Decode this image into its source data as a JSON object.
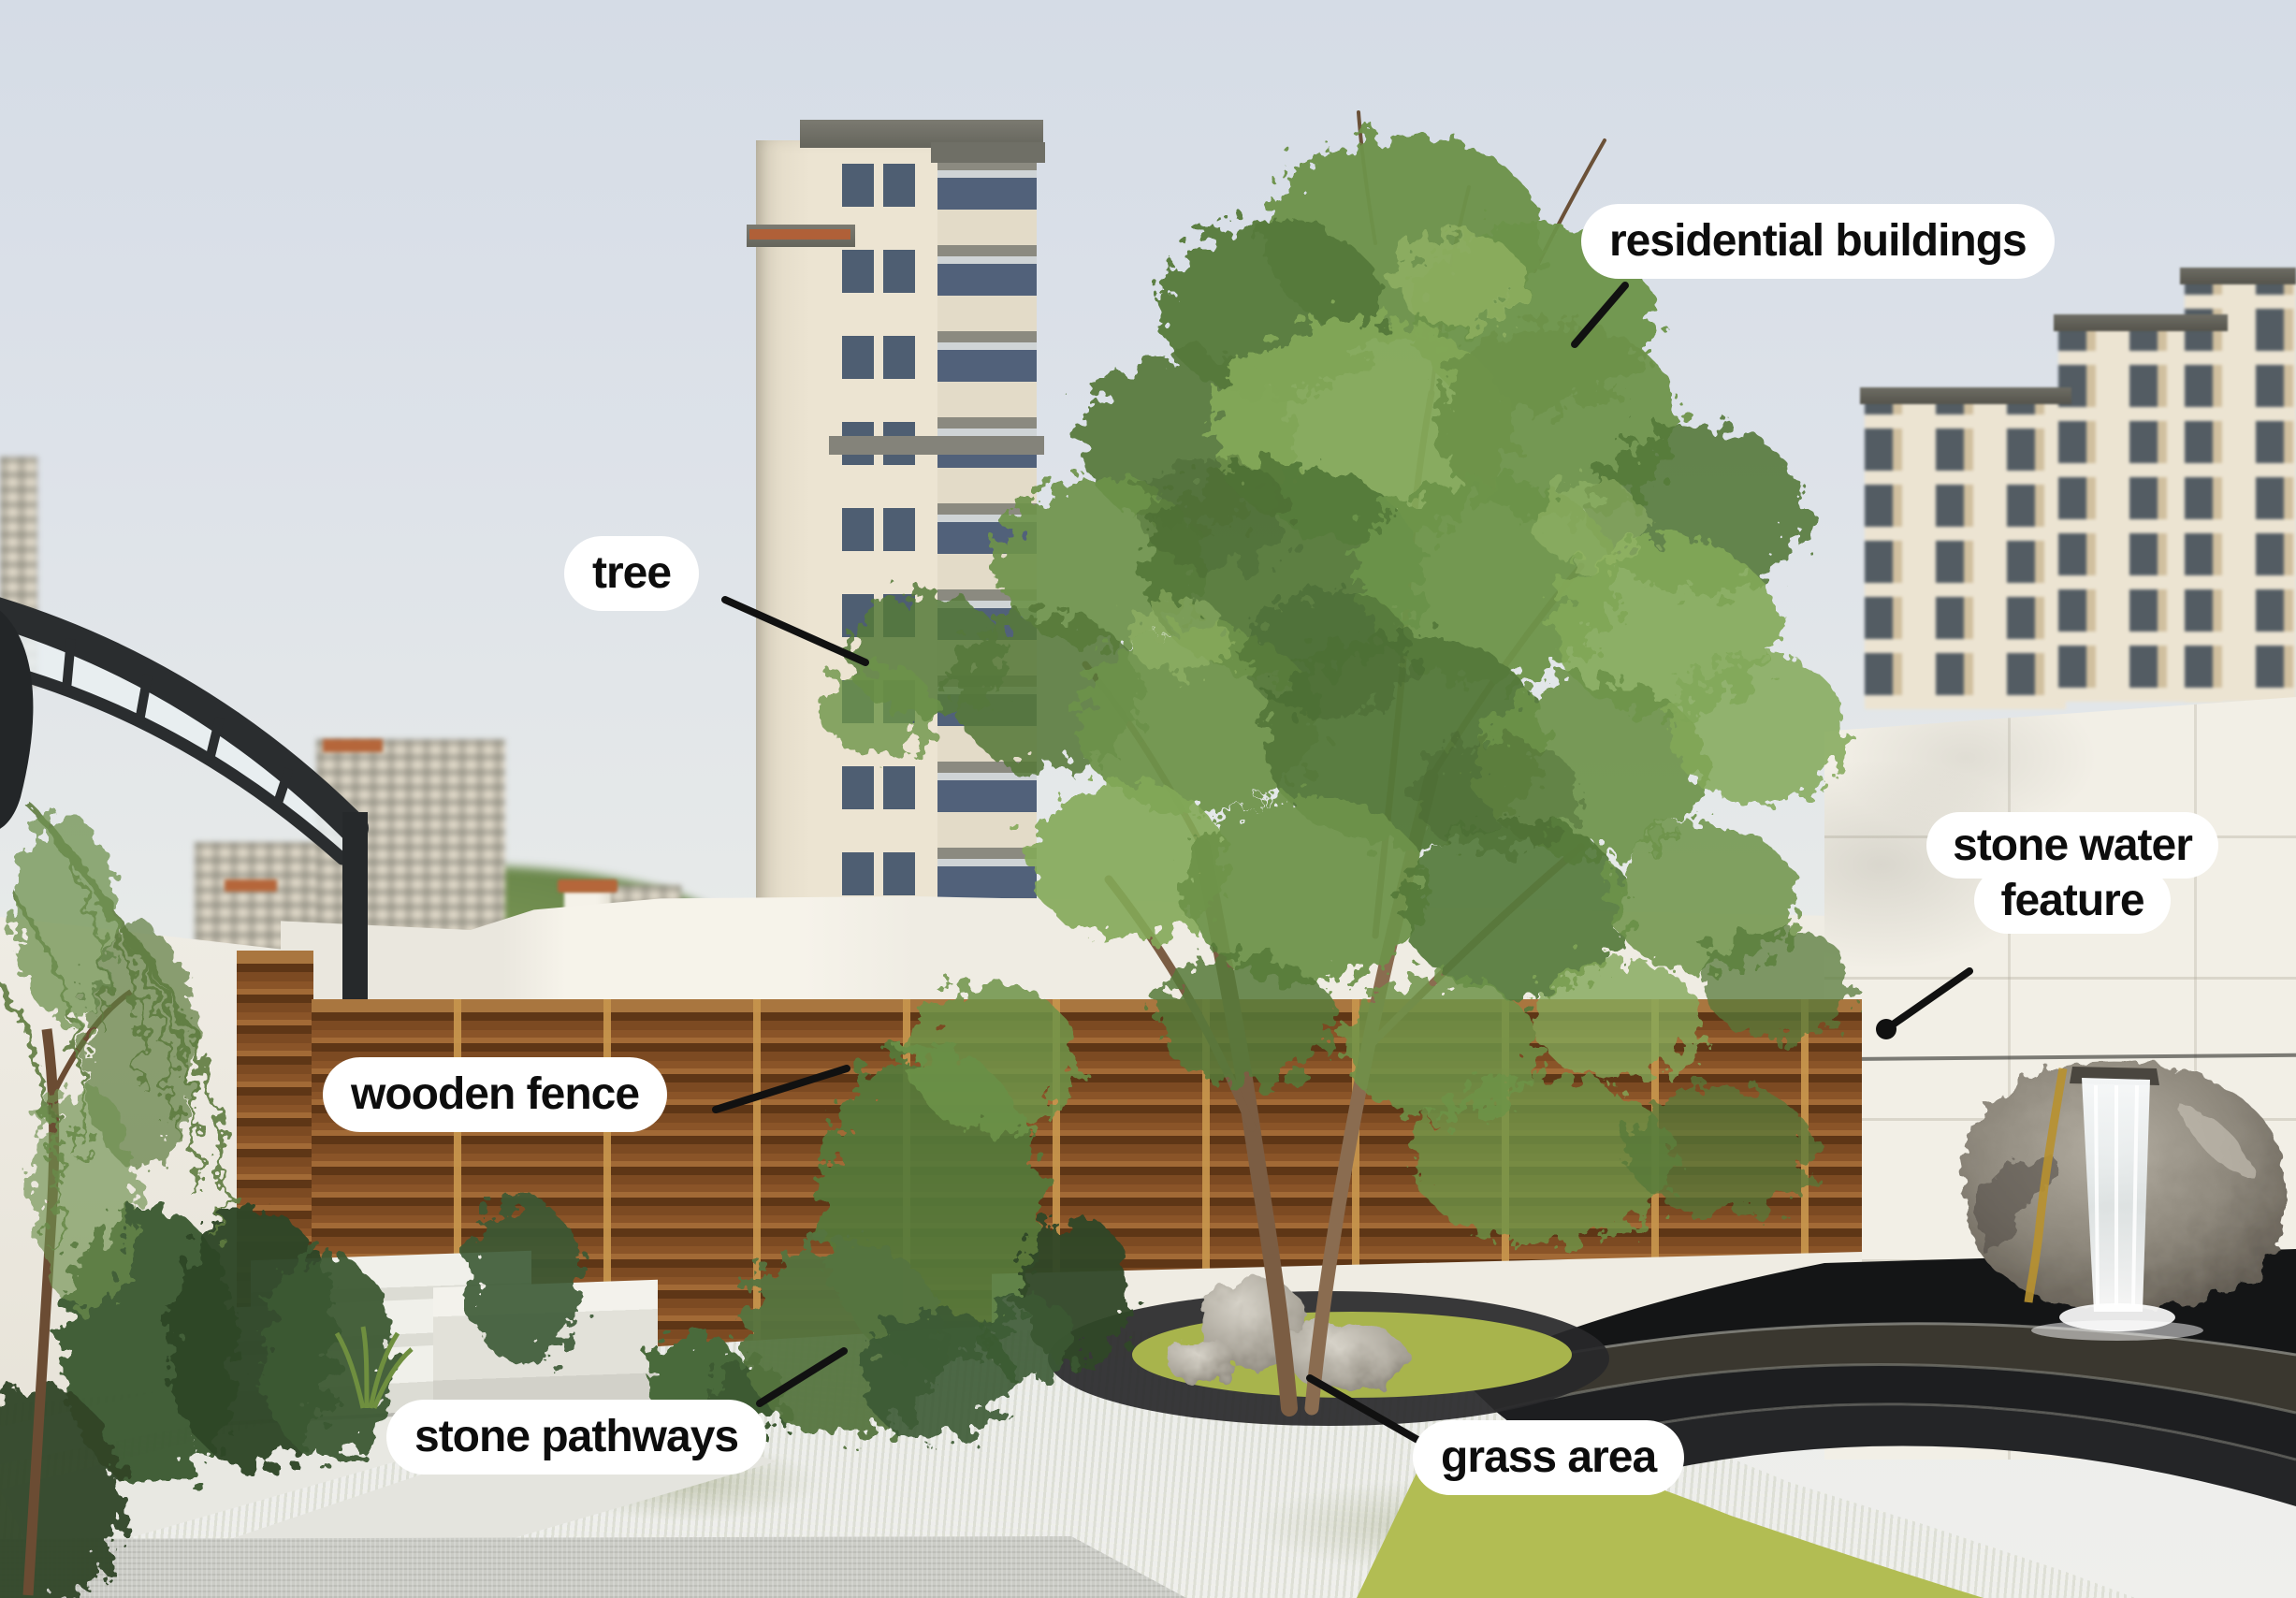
{
  "annotations": {
    "residential_buildings": {
      "label": "residential buildings"
    },
    "tree": {
      "label": "tree"
    },
    "stone_water_feature": {
      "label": "stone water feature",
      "line1": "stone water",
      "line2": "feature"
    },
    "wooden_fence": {
      "label": "wooden fence"
    },
    "stone_pathways": {
      "label": "stone pathways"
    },
    "grass_area": {
      "label": "grass area"
    }
  },
  "palette": {
    "sky": "#d9dfe7",
    "label_bg": "#ffffff",
    "label_text": "#0d0d0d",
    "leader_line": "#111111",
    "fence_wood": "#7c4a22",
    "grass": "#aab64d",
    "wall": "#f1eee6",
    "building_facade": "#ece4d2",
    "foliage": "#6d9349",
    "stone_dark": "#1d1e20",
    "rock": "#8d877b",
    "water": "#eef3f5",
    "pergola": "#2a2d2f"
  }
}
